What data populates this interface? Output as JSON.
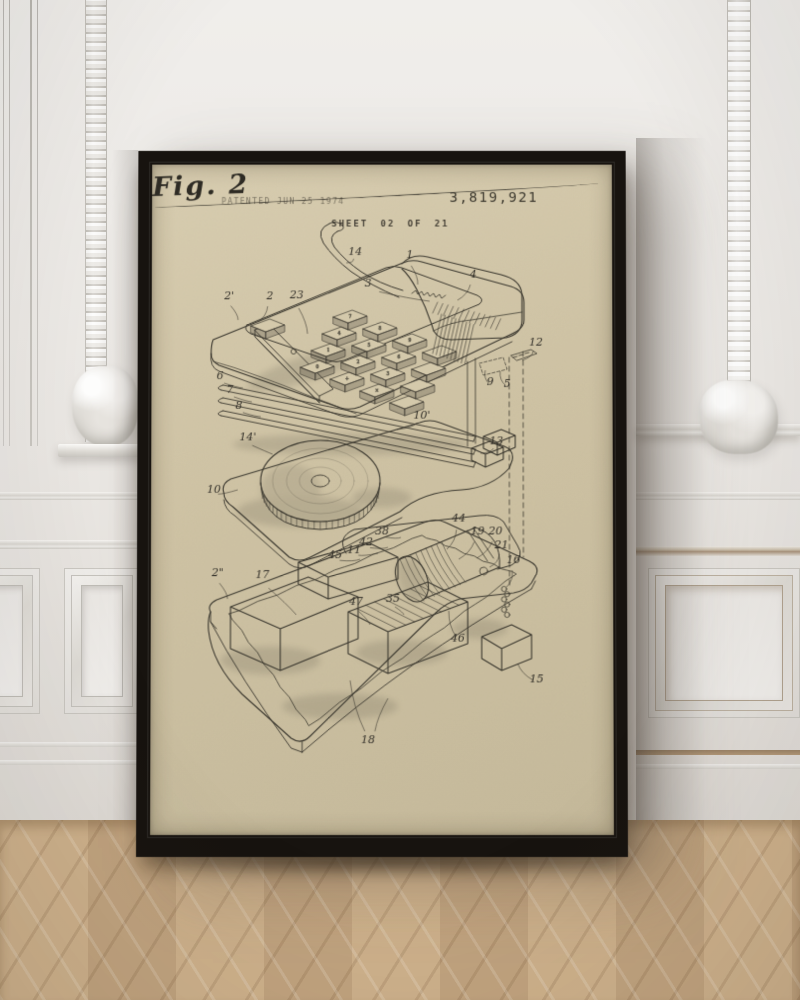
{
  "poster": {
    "stamp": "PATENTED JUN 25 1974",
    "patent_number": "3,819,921",
    "sheet": "SHEET 02 OF 21",
    "figure": "Fig. 2"
  },
  "scene": {
    "frame_color": "#17130f",
    "paper_color": "#cfc3a4",
    "ink_color": "#3b382f",
    "wall_color": "#eae7e3",
    "floor_color": "#ccae88"
  },
  "drawing": {
    "subject": "exploded-view-calculator",
    "labels": [
      {
        "t": "14",
        "x": 205,
        "y": 92,
        "tx": 196,
        "ty": 100
      },
      {
        "t": "1",
        "x": 260,
        "y": 95,
        "tx": 268,
        "ty": 122
      },
      {
        "t": "3",
        "x": 218,
        "y": 124,
        "tx": 280,
        "ty": 139
      },
      {
        "t": "4",
        "x": 324,
        "y": 115,
        "tx": 308,
        "ty": 138
      },
      {
        "t": "2'",
        "x": 78,
        "y": 137,
        "tx": 87,
        "ty": 158
      },
      {
        "t": "2",
        "x": 119,
        "y": 137,
        "tx": 107,
        "ty": 160
      },
      {
        "t": "23",
        "x": 146,
        "y": 136,
        "tx": 157,
        "ty": 172
      },
      {
        "t": "12",
        "x": 387,
        "y": 184,
        "tx": 373,
        "ty": 199
      },
      {
        "t": "6",
        "x": 69,
        "y": 218,
        "tx": 92,
        "ty": 227
      },
      {
        "t": "7",
        "x": 79,
        "y": 232,
        "tx": 101,
        "ty": 241
      },
      {
        "t": "8",
        "x": 88,
        "y": 248,
        "tx": 110,
        "ty": 256
      },
      {
        "t": "9",
        "x": 341,
        "y": 224,
        "tx": 336,
        "ty": 209
      },
      {
        "t": "5",
        "x": 358,
        "y": 226,
        "tx": 351,
        "ty": 210
      },
      {
        "t": "10'",
        "x": 272,
        "y": 258,
        "tx": 247,
        "ty": 269
      },
      {
        "t": "14'",
        "x": 97,
        "y": 280,
        "tx": 122,
        "ty": 294
      },
      {
        "t": "13",
        "x": 347,
        "y": 284,
        "tx": 331,
        "ty": 293
      },
      {
        "t": "10",
        "x": 63,
        "y": 333,
        "tx": 87,
        "ty": 330
      },
      {
        "t": "44",
        "x": 309,
        "y": 362,
        "tx": 297,
        "ty": 390
      },
      {
        "t": "38",
        "x": 232,
        "y": 375,
        "tx": 251,
        "ty": 378
      },
      {
        "t": "19",
        "x": 328,
        "y": 375,
        "tx": 309,
        "ty": 400
      },
      {
        "t": "20",
        "x": 346,
        "y": 375,
        "tx": 327,
        "ty": 399
      },
      {
        "t": "42",
        "x": 216,
        "y": 386,
        "tx": 238,
        "ty": 388
      },
      {
        "t": "11",
        "x": 204,
        "y": 394,
        "tx": 228,
        "ty": 394
      },
      {
        "t": "45",
        "x": 185,
        "y": 399,
        "tx": 210,
        "ty": 400
      },
      {
        "t": "21",
        "x": 352,
        "y": 389,
        "tx": 340,
        "ty": 408
      },
      {
        "t": "16",
        "x": 364,
        "y": 404,
        "tx": 357,
        "ty": 428
      },
      {
        "t": "2\"",
        "x": 67,
        "y": 417,
        "tx": 77,
        "ty": 440
      },
      {
        "t": "17",
        "x": 112,
        "y": 419,
        "tx": 146,
        "ty": 456
      },
      {
        "t": "47",
        "x": 206,
        "y": 446,
        "tx": 220,
        "ty": 466
      },
      {
        "t": "35",
        "x": 243,
        "y": 443,
        "tx": 254,
        "ty": 456
      },
      {
        "t": "46",
        "x": 308,
        "y": 483,
        "tx": 299,
        "ty": 452
      },
      {
        "t": "15",
        "x": 387,
        "y": 524,
        "tx": 368,
        "ty": 505
      },
      {
        "t": "18",
        "x": 218,
        "y": 585,
        "tx": 200,
        "ty": 522
      },
      {
        "t": "",
        "x": 222,
        "y": 580,
        "tx": 238,
        "ty": 540
      }
    ]
  },
  "keypad": {
    "glyph_rows": [
      [
        "7",
        "8",
        "9",
        ""
      ],
      [
        "4",
        "5",
        "6",
        ""
      ],
      [
        "1",
        "2",
        "3",
        ""
      ],
      [
        "0",
        "+",
        "×",
        ""
      ]
    ]
  }
}
